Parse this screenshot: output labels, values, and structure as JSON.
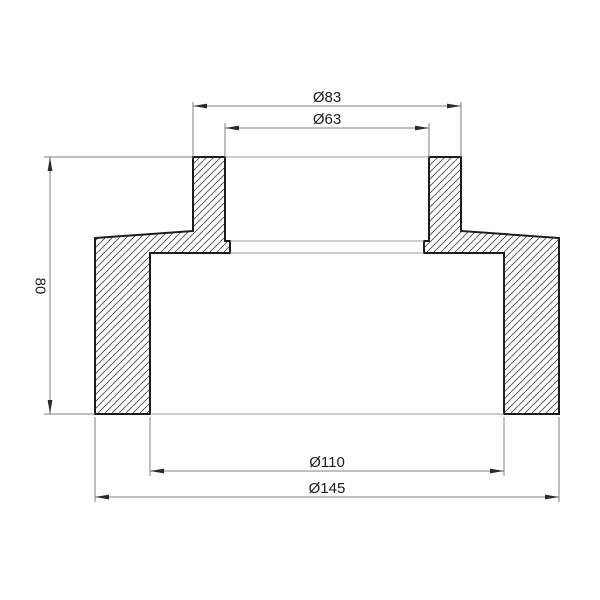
{
  "drawing": {
    "view": "cross-section",
    "background": "#ffffff",
    "outline_color": "#1c1c1c",
    "dimension_line_color": "#7f7f7f",
    "hatch_color": "#4a4a4a",
    "text_color": "#1c1c1c",
    "dimensions": {
      "outer_top_diameter": {
        "label": "Ø83"
      },
      "inner_top_diameter": {
        "label": "Ø63"
      },
      "height": {
        "label": "80"
      },
      "inner_bottom_diameter": {
        "label": "Ø110"
      },
      "outer_bottom_diameter": {
        "label": "Ø145"
      }
    }
  }
}
